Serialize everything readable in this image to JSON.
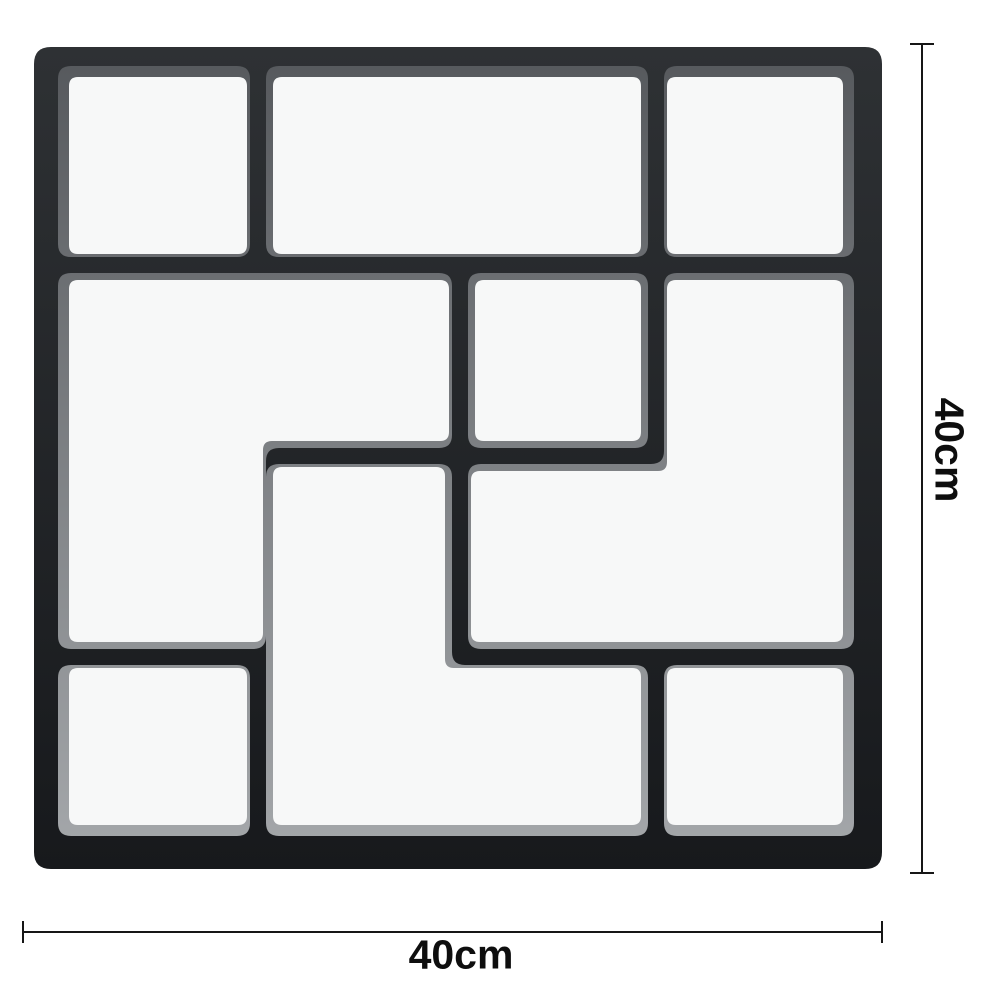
{
  "mold": {
    "colors": {
      "background": "#ffffff",
      "body_top": "#2e3134",
      "body_bottom": "#17191c",
      "bevel_top": "#55585c",
      "bevel_bottom": "#a6a9ac",
      "cell_fill": "#f7f8f8"
    },
    "outer": {
      "x": 34,
      "y": 47,
      "w": 848,
      "h": 822,
      "r": 17
    },
    "cell_corner_radius": 13,
    "inner_corner_radius": 9,
    "cells": [
      {
        "name": "top-left-square",
        "bevel": [
          [
            58,
            66
          ],
          [
            250,
            66
          ],
          [
            250,
            257
          ],
          [
            58,
            257
          ]
        ],
        "inner": [
          [
            69,
            77
          ],
          [
            247,
            77
          ],
          [
            247,
            254
          ],
          [
            69,
            254
          ]
        ]
      },
      {
        "name": "top-middle-rect",
        "bevel": [
          [
            266,
            66
          ],
          [
            648,
            66
          ],
          [
            648,
            257
          ],
          [
            266,
            257
          ]
        ],
        "inner": [
          [
            273,
            77
          ],
          [
            641,
            77
          ],
          [
            641,
            254
          ],
          [
            273,
            254
          ]
        ]
      },
      {
        "name": "top-right-square",
        "bevel": [
          [
            664,
            66
          ],
          [
            854,
            66
          ],
          [
            854,
            257
          ],
          [
            664,
            257
          ]
        ],
        "inner": [
          [
            667,
            77
          ],
          [
            843,
            77
          ],
          [
            843,
            254
          ],
          [
            667,
            254
          ]
        ]
      },
      {
        "name": "west-l-shape",
        "bevel": [
          [
            58,
            273
          ],
          [
            452,
            273
          ],
          [
            452,
            448
          ],
          [
            266,
            448
          ],
          [
            266,
            649
          ],
          [
            58,
            649
          ]
        ],
        "inner": [
          [
            69,
            280
          ],
          [
            449,
            280
          ],
          [
            449,
            441
          ],
          [
            263,
            441
          ],
          [
            263,
            642
          ],
          [
            69,
            642
          ]
        ]
      },
      {
        "name": "center-square",
        "bevel": [
          [
            468,
            273
          ],
          [
            648,
            273
          ],
          [
            648,
            448
          ],
          [
            468,
            448
          ]
        ],
        "inner": [
          [
            475,
            280
          ],
          [
            641,
            280
          ],
          [
            641,
            441
          ],
          [
            475,
            441
          ]
        ]
      },
      {
        "name": "east-l-shape",
        "bevel": [
          [
            664,
            273
          ],
          [
            854,
            273
          ],
          [
            854,
            649
          ],
          [
            468,
            649
          ],
          [
            468,
            464
          ],
          [
            664,
            464
          ]
        ],
        "inner": [
          [
            667,
            280
          ],
          [
            843,
            280
          ],
          [
            843,
            642
          ],
          [
            471,
            642
          ],
          [
            471,
            471
          ],
          [
            667,
            471
          ]
        ]
      },
      {
        "name": "south-l-shape",
        "bevel": [
          [
            266,
            464
          ],
          [
            452,
            464
          ],
          [
            452,
            665
          ],
          [
            648,
            665
          ],
          [
            648,
            836
          ],
          [
            266,
            836
          ]
        ],
        "inner": [
          [
            273,
            467
          ],
          [
            445,
            467
          ],
          [
            445,
            668
          ],
          [
            641,
            668
          ],
          [
            641,
            825
          ],
          [
            273,
            825
          ]
        ]
      },
      {
        "name": "bottom-left-square",
        "bevel": [
          [
            58,
            665
          ],
          [
            250,
            665
          ],
          [
            250,
            836
          ],
          [
            58,
            836
          ]
        ],
        "inner": [
          [
            69,
            668
          ],
          [
            247,
            668
          ],
          [
            247,
            825
          ],
          [
            69,
            825
          ]
        ]
      },
      {
        "name": "bottom-right-square",
        "bevel": [
          [
            664,
            665
          ],
          [
            854,
            665
          ],
          [
            854,
            836
          ],
          [
            664,
            836
          ]
        ],
        "inner": [
          [
            667,
            668
          ],
          [
            843,
            668
          ],
          [
            843,
            825
          ],
          [
            667,
            825
          ]
        ]
      }
    ]
  },
  "dimensions": {
    "height": {
      "label": "40cm",
      "x": 921,
      "y1": 44,
      "y2": 873,
      "cap_w": 24,
      "label_cx": 949,
      "label_cy": 450
    },
    "width": {
      "label": "40cm",
      "y": 931,
      "x1": 23,
      "x2": 882,
      "cap_h": 22,
      "label_cx": 461,
      "label_cy": 955
    }
  }
}
